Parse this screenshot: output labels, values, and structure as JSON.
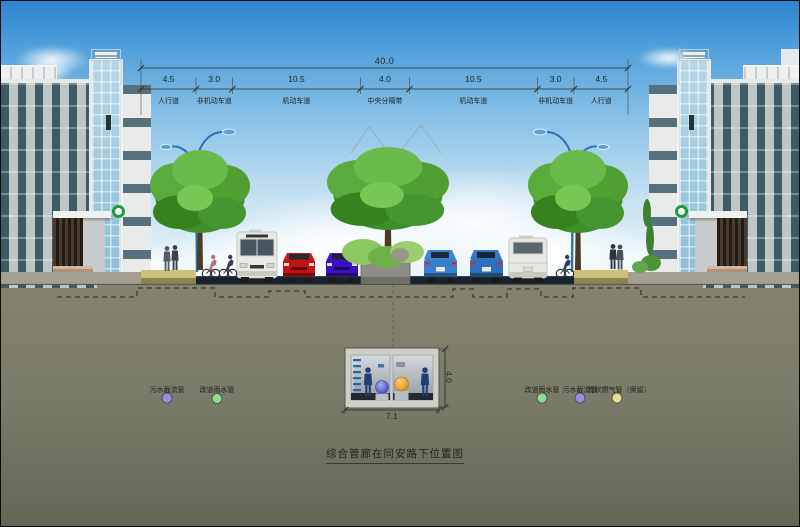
{
  "title": "综合管廊在同安路下位置图",
  "dims": {
    "total": "40.0",
    "segments": [
      {
        "width": "4.5",
        "label": "人行道"
      },
      {
        "width": "3.0",
        "label": "非机动车道"
      },
      {
        "width": "10.5",
        "label": "机动车道"
      },
      {
        "width": "4.0",
        "label": "中央分隔带"
      },
      {
        "width": "10.5",
        "label": "机动车道"
      },
      {
        "width": "3.0",
        "label": "非机动车道"
      },
      {
        "width": "4.5",
        "label": "人行道"
      }
    ],
    "tunnel_width": "7.1",
    "tunnel_height": "4.0"
  },
  "legend": {
    "left": [
      {
        "label": "污水截流管",
        "color": "#958ee4"
      },
      {
        "label": "改道雨水管",
        "color": "#8fdc8f"
      }
    ],
    "right": [
      {
        "label": "改道雨水管",
        "color": "#8fdc8f"
      },
      {
        "label": "污水截流管",
        "color": "#958ee4"
      },
      {
        "label": "现状燃气管（保留）",
        "color": "#e6df96"
      }
    ]
  },
  "colors": {
    "sky_top": "#2d85ce",
    "sky_horizon": "#ecf6fb",
    "ground": "#7b7b69",
    "asphalt": "#18222f",
    "sidewalk": "#cdc07c",
    "median": "#8d8d85",
    "tunnel_concrete": "#cfcfc7",
    "sewage_sphere": "#4646c6",
    "rainwater_sphere": "#e8920f",
    "logo_green": "#1f9a3f",
    "lamp_blue": "#2b72b4"
  }
}
